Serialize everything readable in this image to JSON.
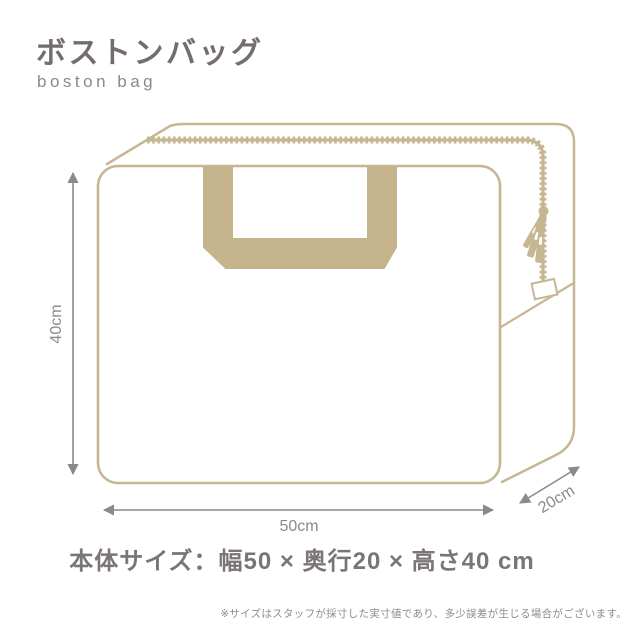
{
  "header": {
    "title": "ボストンバッグ",
    "subtitle": "boston bag"
  },
  "diagram": {
    "subject": "boston-bag-line-illustration",
    "height_label": "40cm",
    "width_label": "50cm",
    "depth_label": "20cm"
  },
  "summary": {
    "body_size_text": "本体サイズ：幅50 × 奥行20 × 高さ40 cm"
  },
  "footnote": {
    "text": "※サイズはスタッフが採寸した実寸値であり、多少誤差が生じる場合がございます。"
  },
  "colors": {
    "illustration_tan": "#c6b692",
    "handle_tan": "#c4b38b",
    "heading_gray": "#736d6d",
    "dimension_gray": "#8a8a8a",
    "size_text_gray": "#7b7575",
    "footnote_gray": "#908b8b",
    "background": "#ffffff"
  }
}
